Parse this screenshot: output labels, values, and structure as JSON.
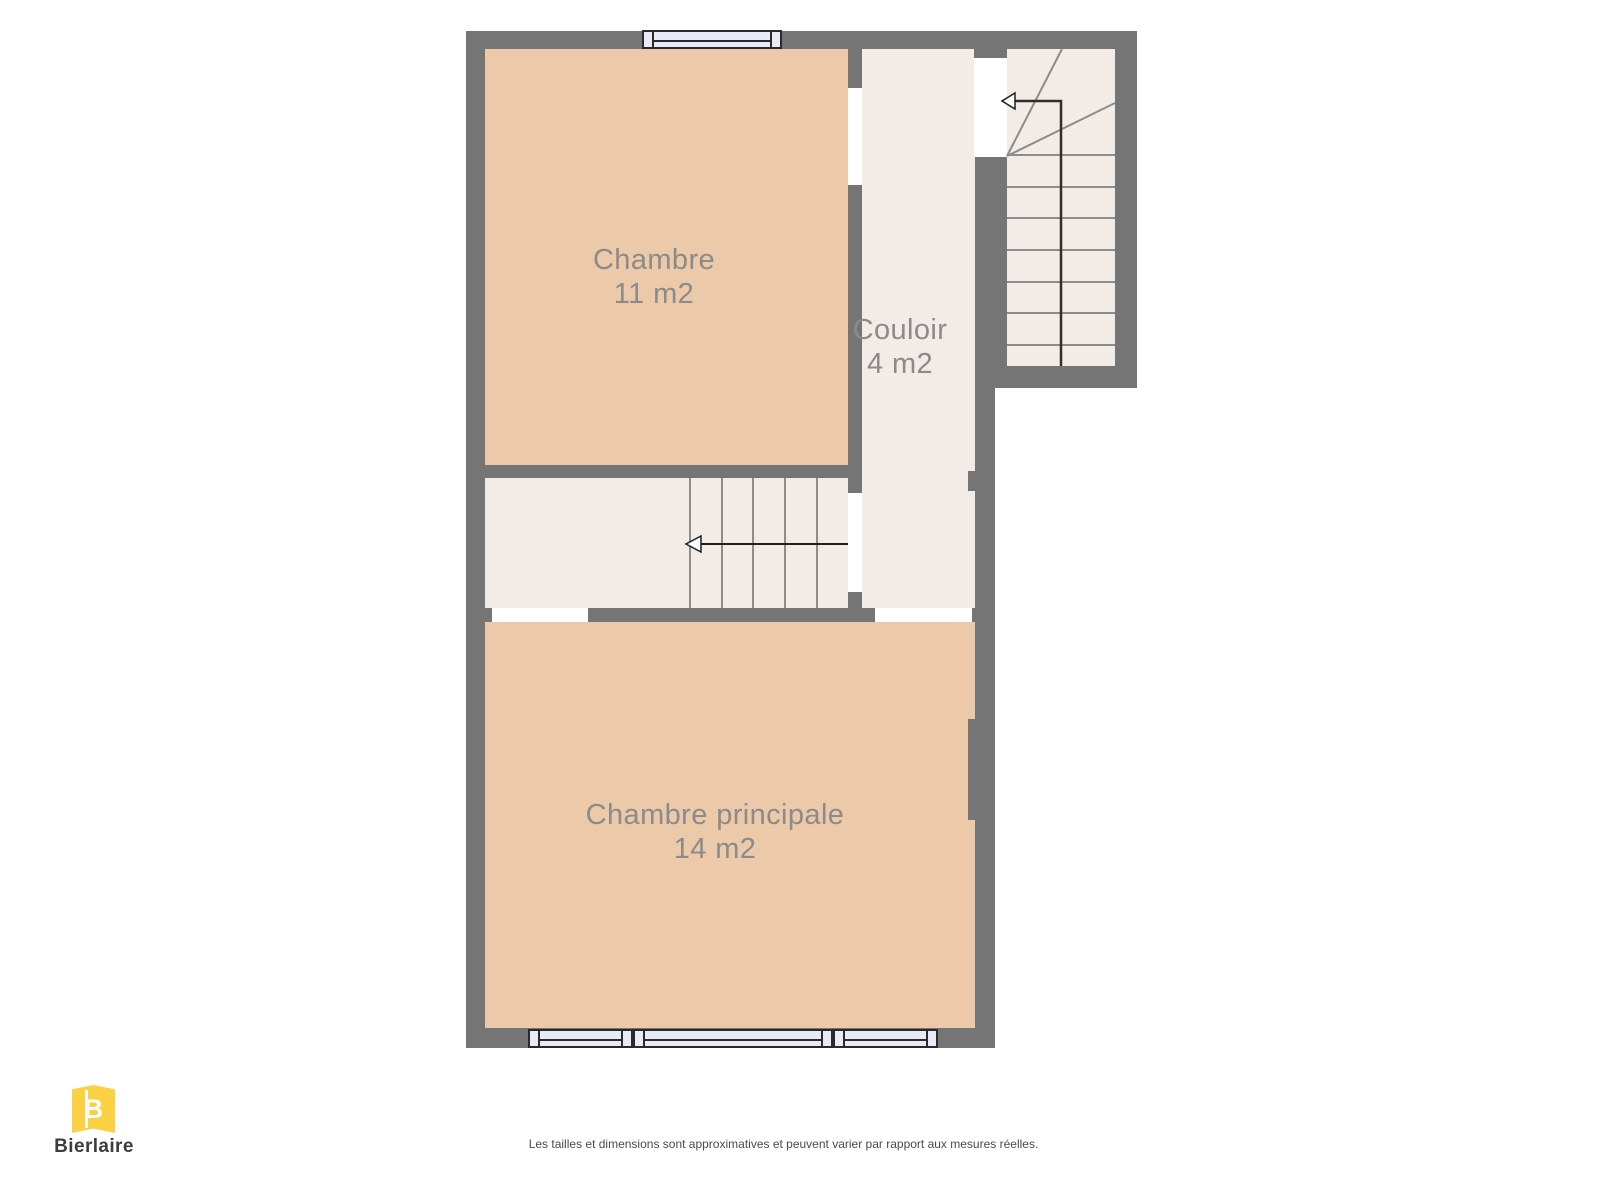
{
  "palette": {
    "wall": "#757575",
    "room_warm_fill": "#ECC9A8",
    "room_light_fill": "#F3EBE5",
    "stair_line": "#8C8C8C",
    "room_label_text": "#8B8B8B",
    "window_fill": "#E8EAF6",
    "window_frame": "#2A2A2A",
    "arrow": "#1F1F1F",
    "brand_yellow": "#FBD144",
    "brand_text": "#3D3D3D",
    "disclaimer_text": "#4A4A4A"
  },
  "rooms": [
    {
      "label": "Chambre",
      "area": "11 m2"
    },
    {
      "label": "Couloir",
      "area": "4 m2"
    },
    {
      "label": "Chambre principale",
      "area": "14 m2"
    }
  ],
  "branding": {
    "name": "Bierlaire",
    "monogram": "B"
  },
  "footer": {
    "disclaimer": "Les tailles et dimensions sont approximatives et peuvent varier par rapport aux mesures réelles."
  }
}
